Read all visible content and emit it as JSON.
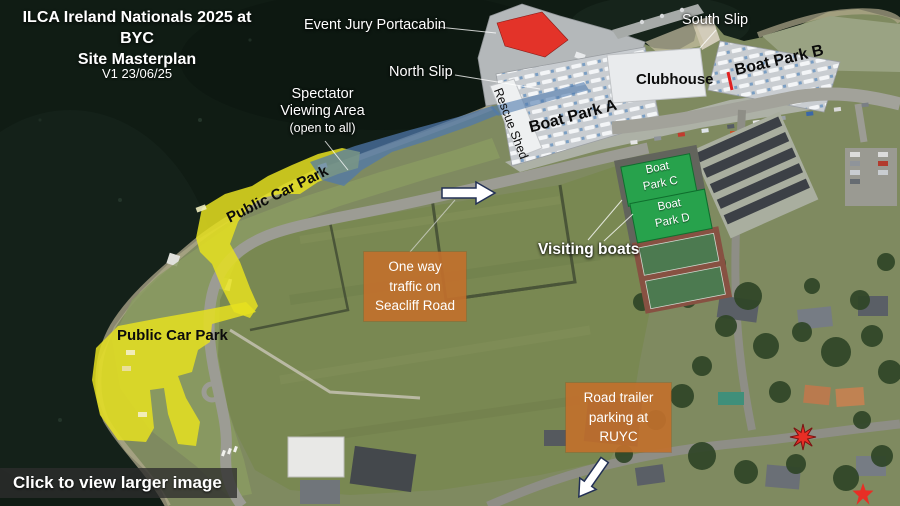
{
  "header": {
    "title_line1": "ILCA Ireland Nationals 2025 at BYC",
    "title_line2": "Site Masterplan",
    "version": "V1 23/06/25"
  },
  "map_labels": {
    "event_jury": "Event Jury Portacabin",
    "north_slip": "North Slip",
    "south_slip": "South Slip",
    "clubhouse": "Clubhouse",
    "boat_park_a": "Boat Park A",
    "boat_park_b": "Boat Park B",
    "rescue_shed": "Rescue Shed",
    "visiting_boats": "Visiting boats",
    "public_car_park_upper": "Public Car Park",
    "public_car_park_lower": "Public Car Park",
    "boat_park_c": {
      "line1": "Boat",
      "line2": "Park C"
    },
    "boat_park_d": {
      "line1": "Boat",
      "line2": "Park D"
    },
    "spectator": {
      "line1": "Spectator",
      "line2": "Viewing Area",
      "line3": "(open to all)"
    }
  },
  "callouts": {
    "one_way": {
      "line1": "One way",
      "line2": "traffic on",
      "line3": "Seacliff Road"
    },
    "road_trailer": {
      "line1": "Road trailer",
      "line2": "parking at",
      "line3": "RUYC"
    }
  },
  "footer": {
    "cta": "Click to view larger image"
  },
  "colors": {
    "car_park_highlight": "#e6e020",
    "spectator_highlight": "#4f79ad",
    "event_jury_highlight": "#e62c22",
    "visiting_boats_highlight": "#27a24c",
    "callout_background": "#c1702d",
    "star_marker": "#e82e25"
  }
}
